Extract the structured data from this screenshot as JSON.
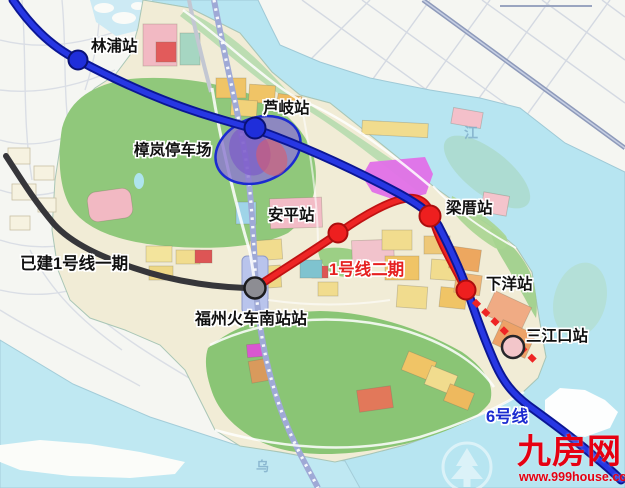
{
  "lines": {
    "line1_built": {
      "label": "已建1号线一期",
      "color": "#36363a"
    },
    "line1_phase2": {
      "label": "1号线二期",
      "color": "#ee2525"
    },
    "line6": {
      "label": "6号线",
      "color": "#1b2bd0"
    }
  },
  "stations": {
    "linpu": {
      "label": "林浦站"
    },
    "luqi": {
      "label": "芦岐站"
    },
    "anping": {
      "label": "安平站"
    },
    "liangcuo": {
      "label": "梁厝站"
    },
    "xiayang": {
      "label": "下洋站"
    },
    "sanjiangkou": {
      "label": "三江口站"
    },
    "fuzhou_south_railway": {
      "label": "福州火车南站站"
    }
  },
  "facilities": {
    "zhanglan_depot": {
      "label": "樟岚停车场"
    }
  },
  "geo_labels": {
    "min_river": "江",
    "wulong_river": "乌"
  },
  "watermark": {
    "site_name": "九房网",
    "site_url": "www.999house.com",
    "color": "#e60012"
  }
}
